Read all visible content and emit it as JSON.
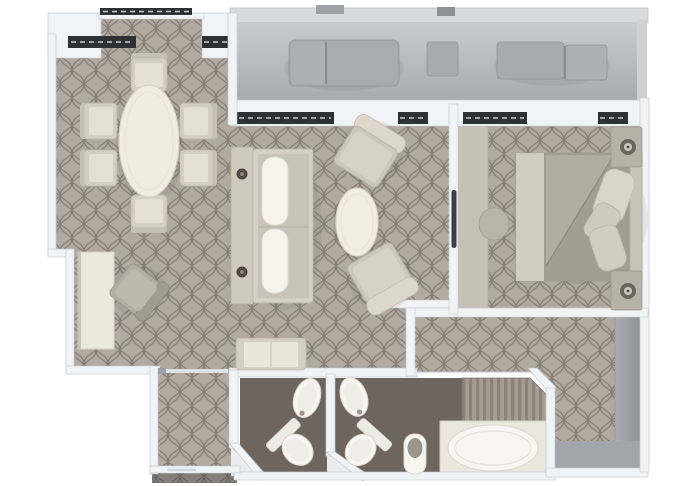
{
  "plan": {
    "kind": "suite-floor-plan-top-view",
    "rooms": [
      {
        "name": "balcony",
        "furniture": [
          "outdoor-sofa",
          "side-table",
          "sun-lounger"
        ]
      },
      {
        "name": "dining-area",
        "furniture": [
          "oval-dining-table",
          "dining-chairs x6"
        ]
      },
      {
        "name": "living-area",
        "furniture": [
          "media-console",
          "sofa",
          "coffee-table",
          "armchairs x2",
          "bench",
          "desk",
          "desk-chair"
        ]
      },
      {
        "name": "bedroom",
        "furniture": [
          "double-bed",
          "pillows x3",
          "nightstands x2",
          "table-lamps x2",
          "dresser",
          "stool",
          "sliding-door"
        ]
      },
      {
        "name": "guest-bathroom",
        "furniture": [
          "washbasin",
          "toilet"
        ]
      },
      {
        "name": "master-bathroom",
        "furniture": [
          "washbasin",
          "toilet",
          "bidet",
          "bathtub",
          "shower"
        ]
      },
      {
        "name": "entry-hall",
        "furniture": []
      },
      {
        "name": "walk-in-wardrobe",
        "furniture": [
          "wardrobe-run"
        ]
      }
    ]
  },
  "colors": {
    "page_bg": "#ffffff",
    "wall_fill": "#f1f4f6",
    "wall_stroke": "#c5cacf",
    "carpet_base": "#b2aaa0",
    "carpet_line": "#6f675e",
    "glass_dark": "#2d3134",
    "balcony_floor_light": "#c9cccf",
    "balcony_floor_dark": "#a6a9ac",
    "balcony_rail": "#d8dbde",
    "balcony_furniture": "#a8abae",
    "bath_floor": "#6e655e",
    "fixture_white": "#f7f6f2",
    "cream_frame": "#d6d0c4",
    "cushion_white": "#f5f3ec",
    "ivory_table": "#f0ecdf",
    "desk_ivory": "#ece8da",
    "bed_base": "#b9b2a9",
    "bed_foot": "#d2ccc1",
    "bed_duvet": "#a39c93",
    "bed_sheet_fold": "#b3aca3",
    "headboard": "#c9c3b8",
    "pillow_light": "#dad4c9",
    "nightstand": "#b7b1a7",
    "lamp_ring": "#6d665f",
    "dresser": "#c6c0b5",
    "stool": "#b9b3a8",
    "wardrobe_gray": "#9ba0a5",
    "closet_floor_strip": "#a2a6aa",
    "corridor_strip": "#8f9498",
    "stripe_light": "#a59d92",
    "stripe_dark": "#8b8379",
    "door_handle_dark": "#3c3f43",
    "pale_floor": "#e9edf0",
    "threshold": "#dfe3e6"
  }
}
